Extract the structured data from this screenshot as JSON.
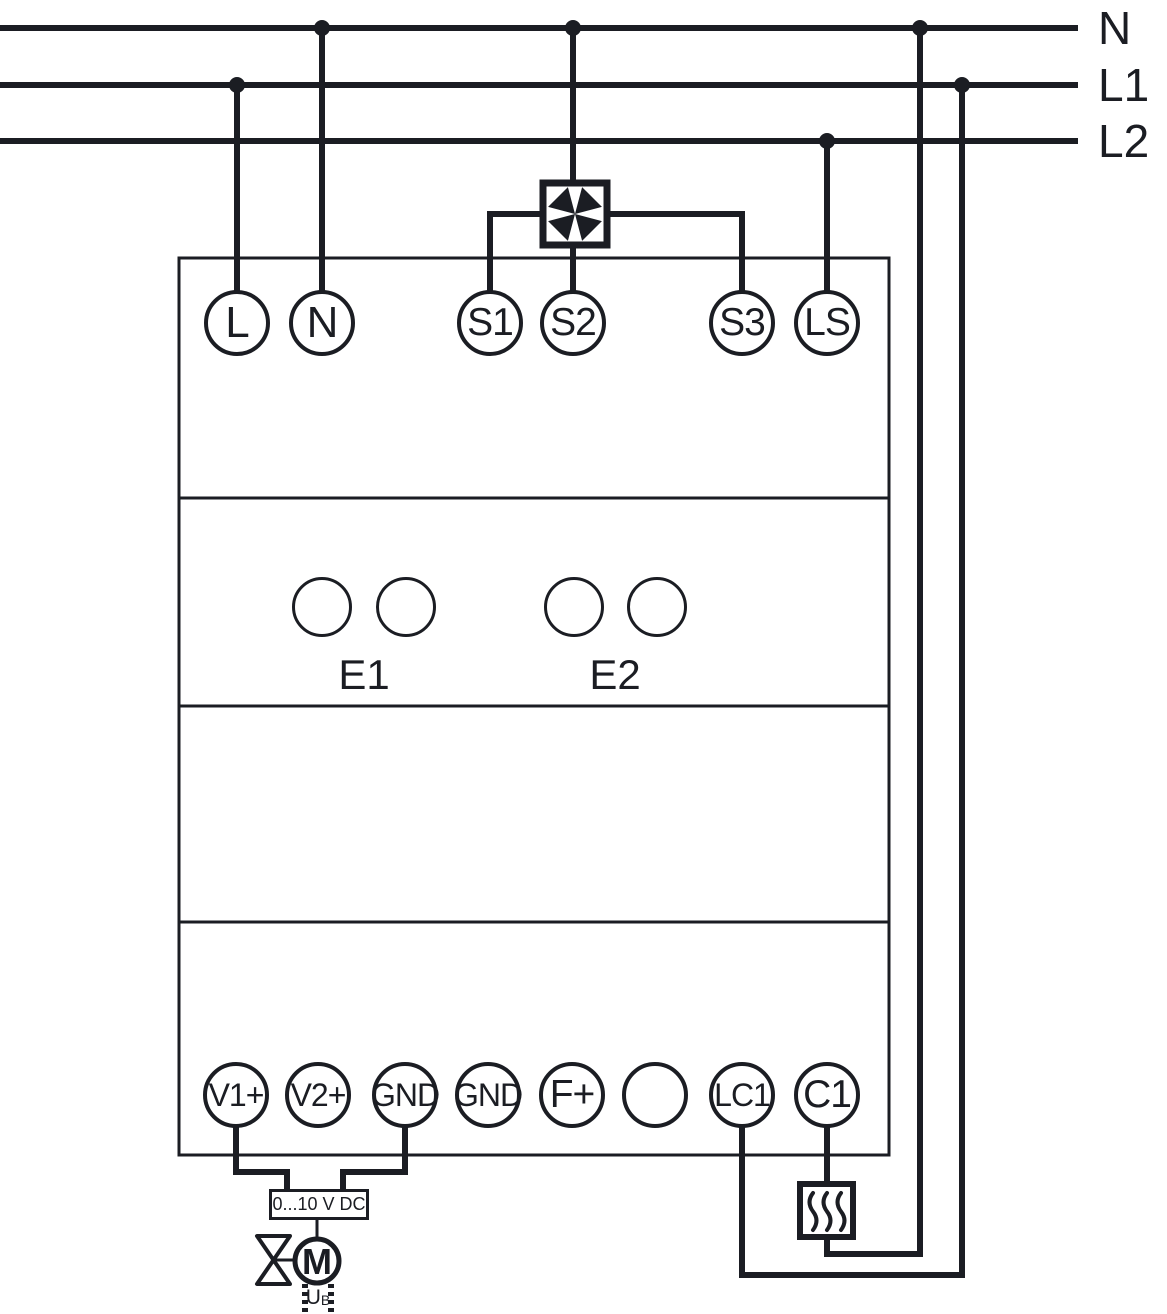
{
  "colors": {
    "line": "#1b1d23",
    "background": "#ffffff"
  },
  "power_lines": [
    "N",
    "L1",
    "L2"
  ],
  "terminals_top": [
    "L",
    "N",
    "S1",
    "S2",
    "S3",
    "LS"
  ],
  "input_groups": [
    "E1",
    "E2"
  ],
  "terminals_bottom": [
    "V1+",
    "V2+",
    "GND",
    "GND",
    "F+",
    "",
    "LC1",
    "C1"
  ],
  "actuator": {
    "signal_label": "0...10 V DC",
    "motor_label": "M",
    "supply_main": "U",
    "supply_sub": "B"
  }
}
